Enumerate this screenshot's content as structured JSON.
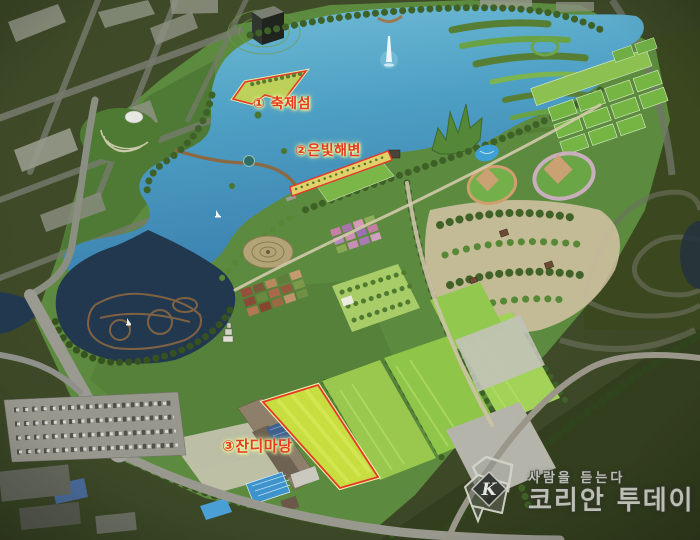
{
  "scene": {
    "type": "aerial-park-masterplan-rendering",
    "colors": {
      "background_forest": "#3c4726",
      "lake_teal": "#4d9fc4",
      "pond_dark": "#22384f",
      "lawn_green": "#8fc549",
      "highlight_yellow_green": "#c8dd3f",
      "annotation_red": "#e5372c",
      "annotation_glow": "#eef79a",
      "watermark_gray": "#cdcfc6"
    }
  },
  "annotations": {
    "items": [
      {
        "label": "① 축제섬"
      },
      {
        "label": "②은빛해변"
      },
      {
        "label": "③잔디마당"
      }
    ]
  },
  "watermark": {
    "monogram": "K",
    "slogan": "사람을 듣는다",
    "brand": "코리안 투데이"
  }
}
